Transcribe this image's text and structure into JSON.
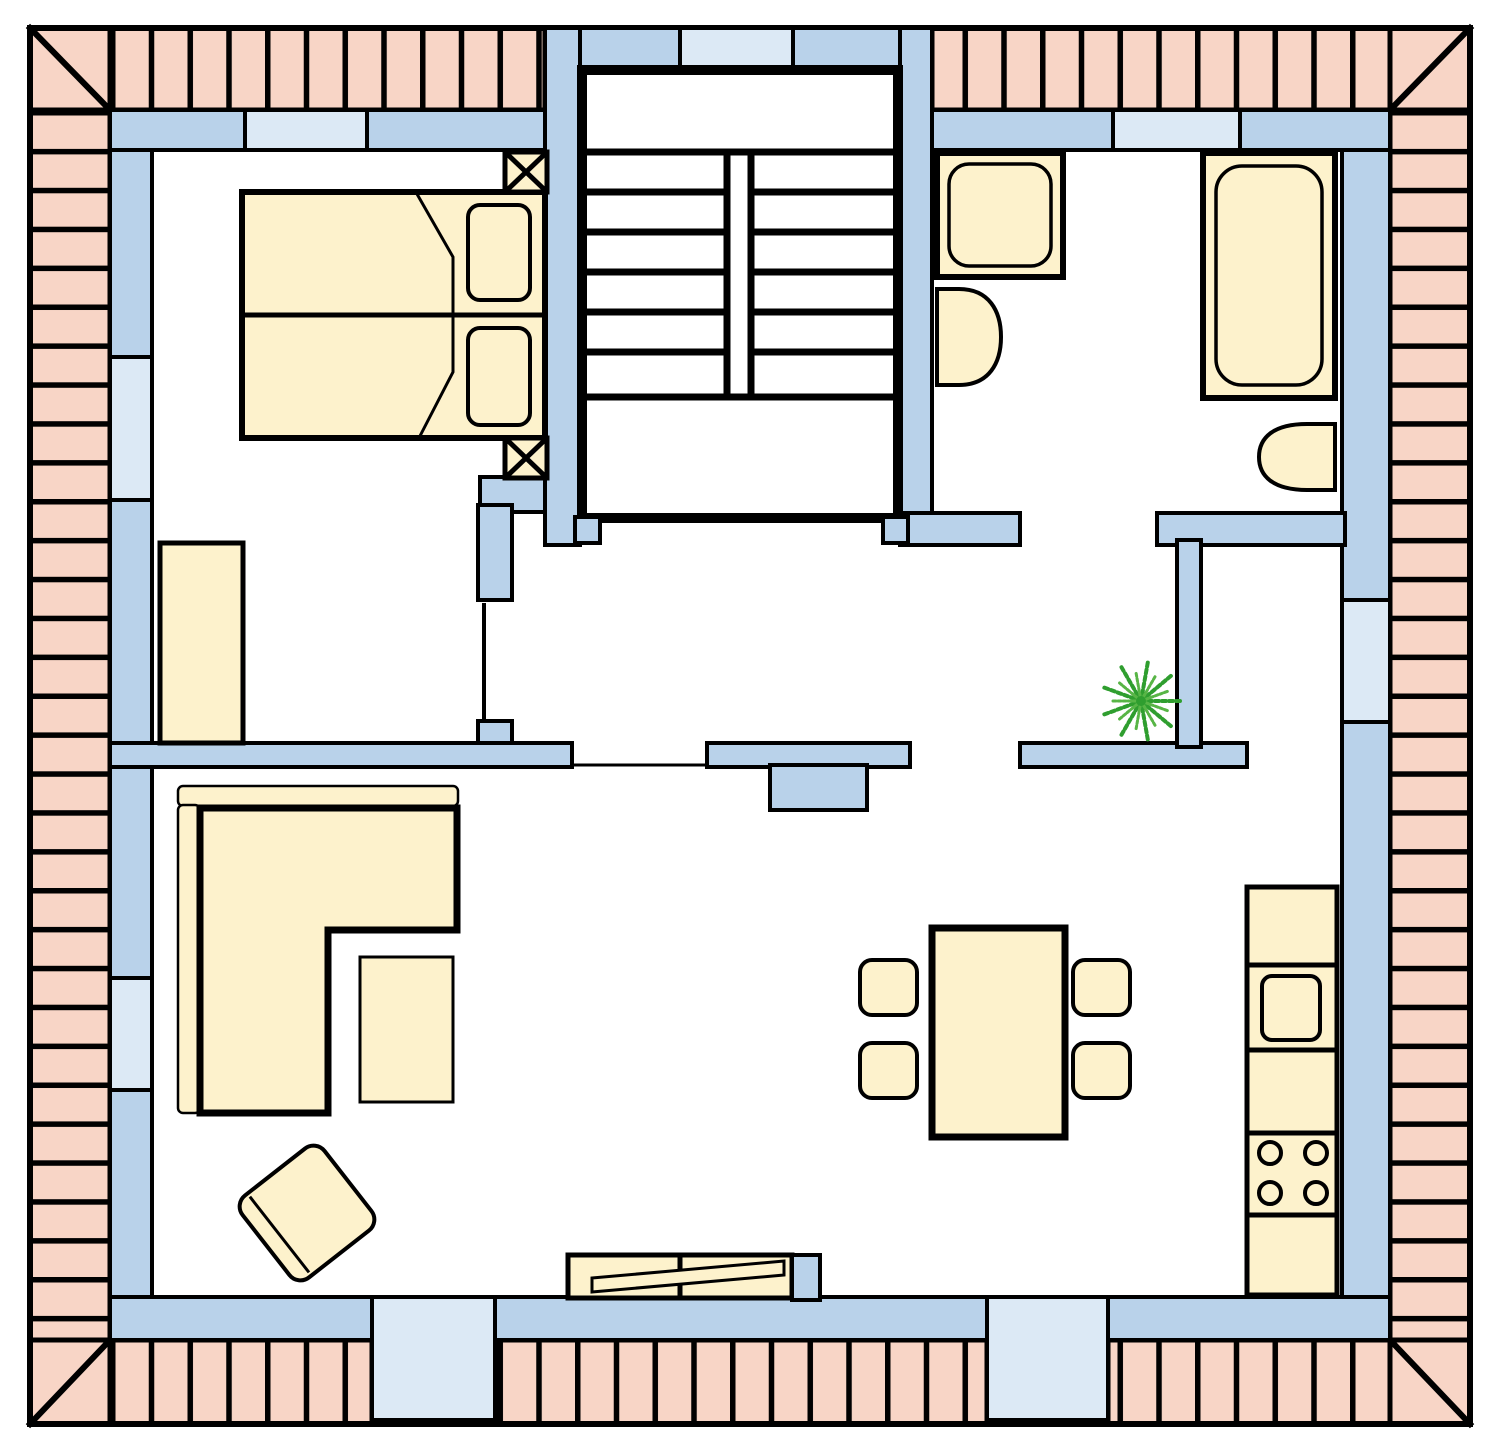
{
  "title": "apartment-floor-plan",
  "colors": {
    "bg": "#ffffff",
    "roof": "#f8d5c6",
    "wall": "#b9d2ea",
    "window": "#dce9f5",
    "furniture": "#fdf2cc",
    "outline": "#000000",
    "plant": "#2f9e2f",
    "plant_light": "#58b546"
  },
  "plan": {
    "type": "floor-plan-top-view",
    "roof_border": {
      "style": "hip-roof-tiles",
      "corner_diagonals": 4
    },
    "rooms": [
      {
        "name": "bedroom",
        "furniture": [
          "double-bed",
          "pillow",
          "pillow",
          "nightstand-x",
          "nightstand-x",
          "wardrobe"
        ]
      },
      {
        "name": "stairwell",
        "stairs": {
          "flights": 2,
          "steps_per_flight": 6,
          "landings": 2
        }
      },
      {
        "name": "bathroom",
        "furniture": [
          "shower",
          "washbasin",
          "bathtub",
          "toilet"
        ]
      },
      {
        "name": "hallway",
        "furniture": [
          "palm-plant"
        ]
      },
      {
        "name": "storage-room",
        "furniture": []
      },
      {
        "name": "living-room",
        "furniture": [
          "corner-sofa",
          "coffee-table",
          "armchair",
          "tv-sideboard",
          "dining-table",
          "dining-chair",
          "dining-chair",
          "dining-chair",
          "dining-chair"
        ]
      },
      {
        "name": "kitchen-row",
        "furniture": [
          "counter-unit",
          "sink-unit",
          "counter-unit",
          "stove-4-burners",
          "counter-unit"
        ]
      }
    ],
    "openings": {
      "windows": [
        "bedroom-top",
        "stairwell-top",
        "bathroom-top",
        "left-wall-upper",
        "left-wall-lower",
        "right-wall"
      ],
      "terrace_doors": [
        "bottom-left",
        "bottom-right"
      ]
    },
    "counts": {
      "dining_chairs": 4,
      "stove_burners": 4,
      "pillows": 2,
      "nightstands": 2,
      "terrace_doors": 2,
      "windows": 6
    }
  }
}
